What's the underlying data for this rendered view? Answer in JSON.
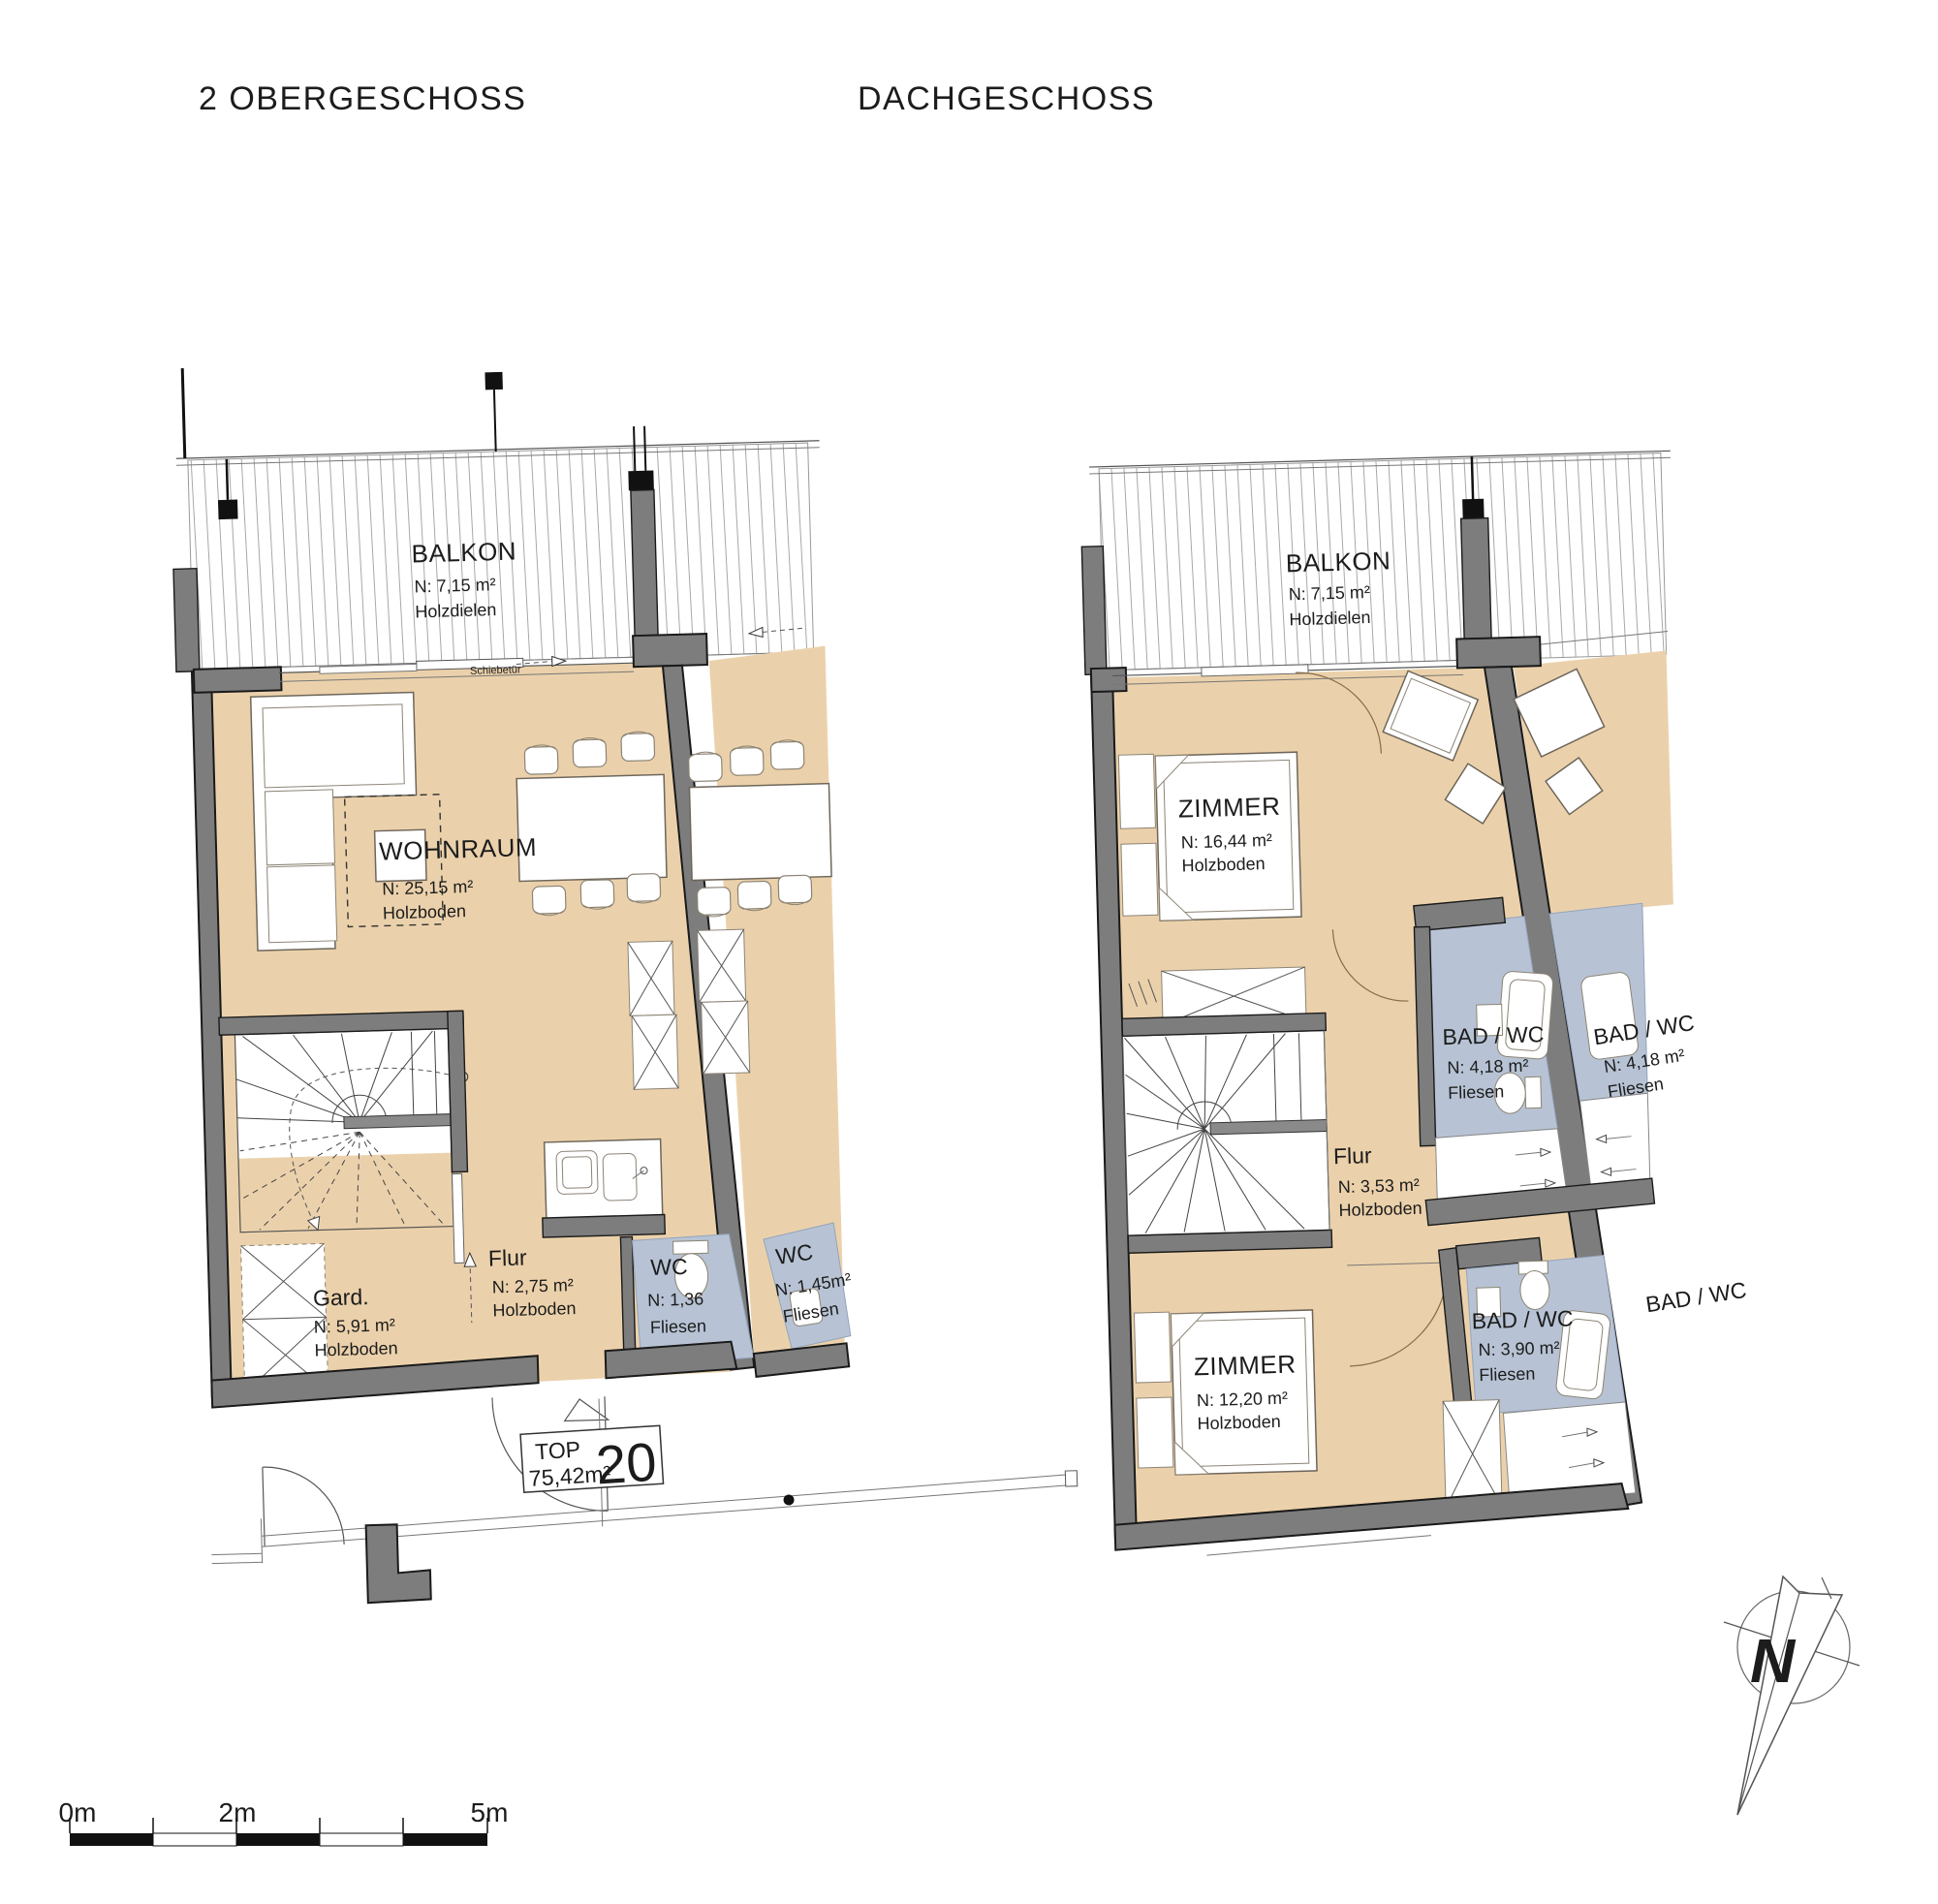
{
  "titles": {
    "left": "2 OBERGESCHOSS",
    "right": "DACHGESCHOSS"
  },
  "plan_left": {
    "balkon": {
      "name": "BALKON",
      "area": "N: 7,15 m²",
      "floor": "Holzdielen"
    },
    "wohnraum": {
      "name": "WOHNRAUM",
      "area": "N: 25,15 m²",
      "floor": "Holzboden"
    },
    "gard": {
      "name": "Gard.",
      "area": "N: 5,91 m²",
      "floor": "Holzboden"
    },
    "flur": {
      "name": "Flur",
      "area": "N: 2,75 m²",
      "floor": "Holzboden"
    },
    "wc": {
      "name": "WC",
      "area": "N: 1,36",
      "floor": "Fliesen"
    },
    "wc_neighbor": {
      "name": "WC",
      "area": "N: 1,45m²",
      "floor": "Fliesen"
    },
    "schiebetuer": "Schiebetür",
    "top_badge": {
      "label": "TOP",
      "area": "75,42m²",
      "number": "20"
    }
  },
  "plan_right": {
    "balkon": {
      "name": "BALKON",
      "area": "N: 7,15 m²",
      "floor": "Holzdielen"
    },
    "zimmer_top": {
      "name": "ZIMMER",
      "area": "N: 16,44 m²",
      "floor": "Holzboden"
    },
    "flur": {
      "name": "Flur",
      "area": "N: 3,53 m²",
      "floor": "Holzboden"
    },
    "bad_top": {
      "name": "BAD / WC",
      "area": "N: 4,18 m²",
      "floor": "Fliesen"
    },
    "bad_top_neighbor": {
      "name": "BAD / WC",
      "area": "N: 4,18 m²",
      "floor": "Fliesen"
    },
    "zimmer_bottom": {
      "name": "ZIMMER",
      "area": "N: 12,20 m²",
      "floor": "Holzboden"
    },
    "bad_bottom": {
      "name": "BAD / WC",
      "area": "N: 3,90 m²",
      "floor": "Fliesen"
    },
    "bad_bottom_neighbor": {
      "name": "BAD / WC"
    }
  },
  "scale_bar": {
    "label_0": "0m",
    "label_2": "2m",
    "label_5": "5m"
  },
  "compass": {
    "label": "N"
  },
  "colors": {
    "wood_floor": "#ebd1ab",
    "tile_floor": "#b7c3d4",
    "wall_gray": "#7d7d7d",
    "line_dark": "#1a1a1a",
    "background": "#ffffff"
  }
}
